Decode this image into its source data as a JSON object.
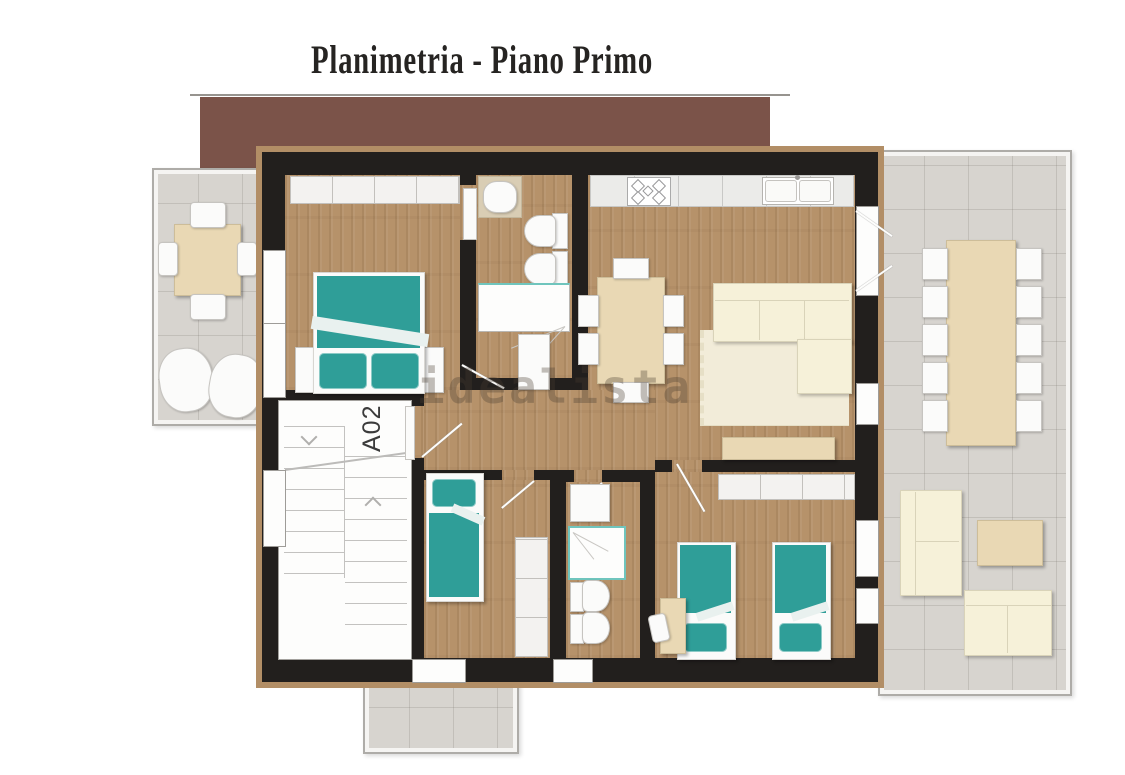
{
  "header": {
    "title": "Planimetria - Piano Primo"
  },
  "plan": {
    "unit_label": "A02",
    "watermark": "idealista",
    "colors": {
      "roof": "#7b5349",
      "wall": "#221f1d",
      "wall-trim": "#b28e66",
      "wood": "#b6926a",
      "tile": "#d7d4cf",
      "teal": "#2f9e98",
      "cream": "#f6f1d9",
      "beige": "#e9d8b4",
      "white-fixture": "#fbfbfa",
      "title-ink": "#262422",
      "watermark-ink": "rgba(74,62,48,0.33)"
    }
  }
}
